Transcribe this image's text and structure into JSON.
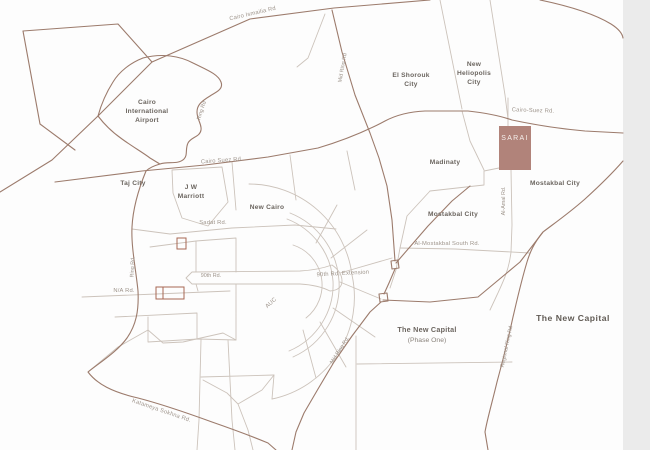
{
  "page": {
    "background": "#fdfdfd",
    "right_gutter_color": "#ebebeb"
  },
  "map": {
    "line_colors": {
      "major_road": "#9c7b6c",
      "minor_road": "#ccc3bb",
      "plot_outline": "#a86752"
    },
    "regions": {
      "cairo_airport": {
        "line1": "Cairo",
        "line2": "International",
        "line3": "Airport"
      },
      "el_shorouk": {
        "line1": "El Shorouk",
        "line2": "City"
      },
      "new_heliopolis": {
        "line1": "New",
        "line2": "Heliopolis",
        "line3": "City"
      },
      "taj_city": "Taj City",
      "jw_marriott": {
        "line1": "J W",
        "line2": "Marriott"
      },
      "new_cairo": "New Cairo",
      "madinaty": "Madinaty",
      "mostakbal_east": "Mostakbal City",
      "mostakbal_west": "Mostakbal City",
      "auc": "AUC",
      "new_capital_phase_one": {
        "line1": "The New Capital",
        "line2": "(Phase One)"
      },
      "new_capital": "The New Capital"
    },
    "roads": {
      "cairo_ismailia": "Cairo Ismailia Rd",
      "mid_ring_north": "Mid Ring Rd",
      "ring_rd_airport": "Ring Rd",
      "cairo_suez_west": "Cairo Suez Rd.",
      "cairo_suez_east": "Cairo-Suez Rd.",
      "sadat": "Sadat Rd.",
      "ring_rd_south": "Ring Rd.",
      "ninetieth": "90th Rd.",
      "ninetieth_extension": "90th Rd. Extension",
      "na_rd": "N/A Rd.",
      "al_amal": "Al-Amal Rd.",
      "al_mostakbal_south": "Al-Mostakbal South Rd.",
      "mid_ring_south": "Mid Ring Rd.",
      "regional_ring": "Regional Ring Rd",
      "katameya_sokhna": "Katameya Sokhna Rd."
    },
    "highlight": {
      "label": "SARAI",
      "fill": "#b1837a",
      "text_color": "#f6f0ed"
    }
  }
}
